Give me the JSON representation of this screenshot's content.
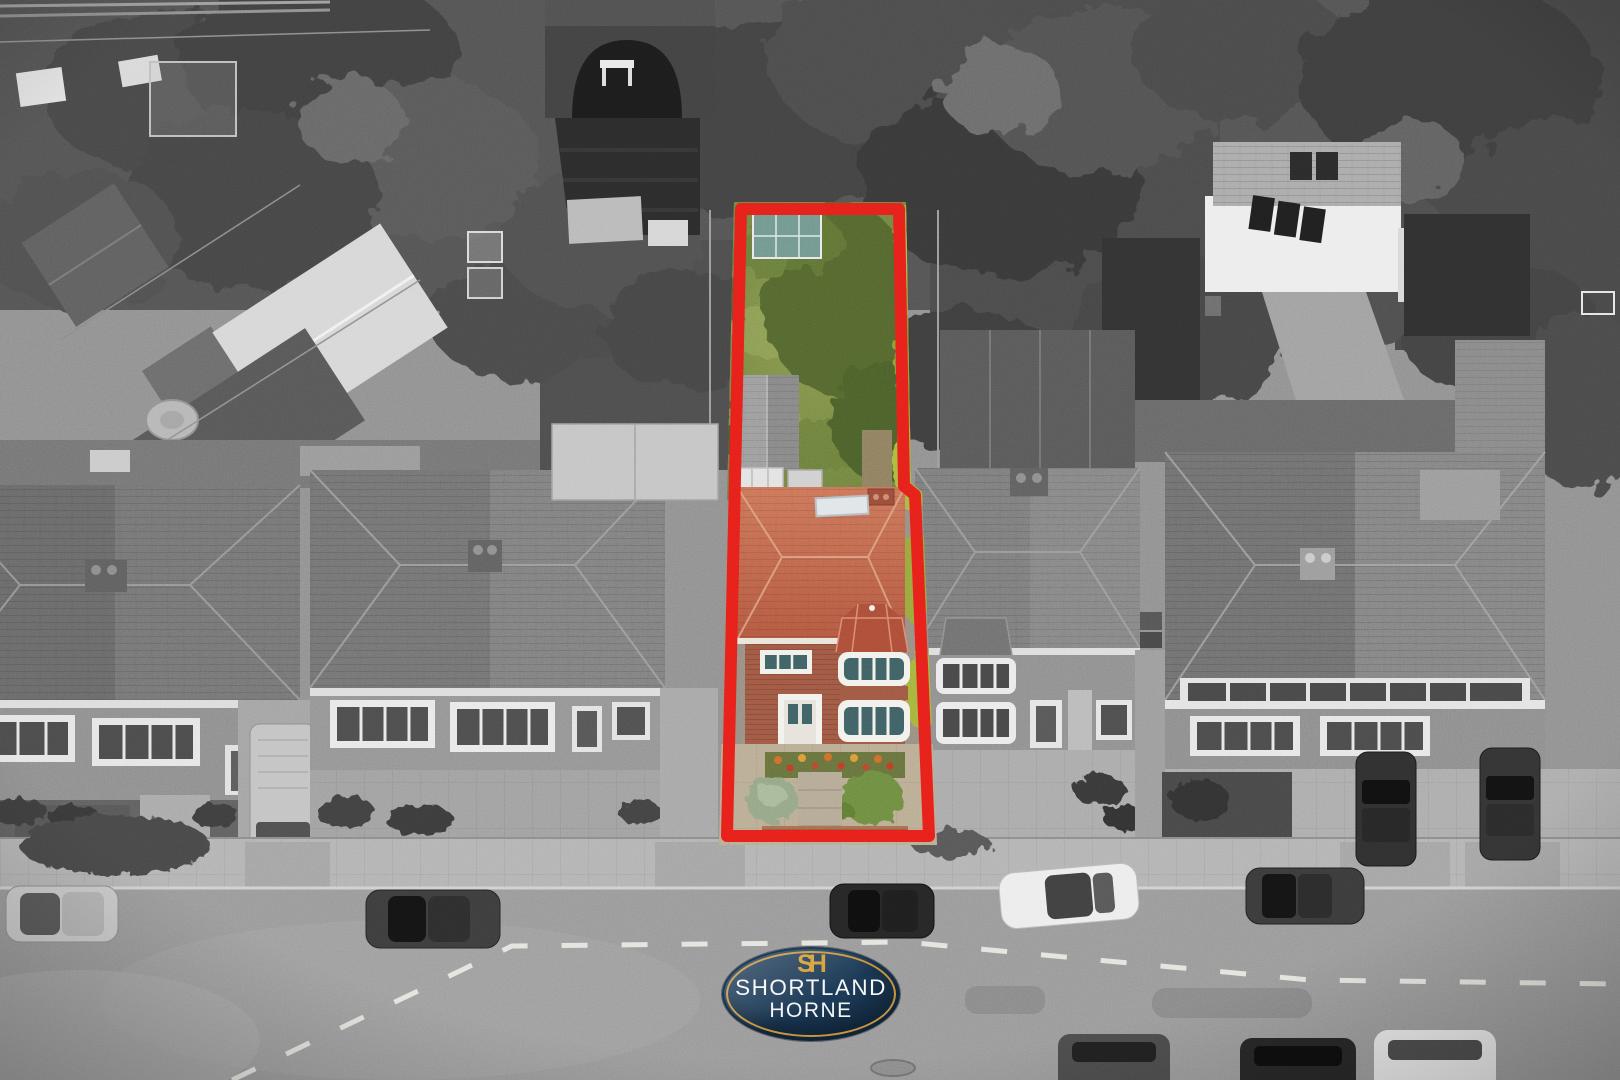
{
  "brand": {
    "monogram": "SH",
    "line1": "SHORTLAND",
    "line2": "HORNE"
  },
  "highlight": {
    "outline_width": 12,
    "polygon": [
      [
        741,
        209
      ],
      [
        899,
        209
      ],
      [
        904,
        486
      ],
      [
        915,
        495
      ],
      [
        929,
        836
      ],
      [
        727,
        836
      ]
    ],
    "clip": [
      [
        734,
        202
      ],
      [
        906,
        202
      ],
      [
        911,
        483
      ],
      [
        922,
        492
      ],
      [
        937,
        845
      ],
      [
        719,
        845
      ]
    ]
  },
  "palette": {
    "outline-red": "#e6201a",
    "badge-navy": "#1d3b58",
    "badge-navy-dark": "#0f2438",
    "badge-gold": "#c8953c",
    "monogram-gold": "#d69d2d",
    "brand-text": "#f4f6f8",
    "roof-terracotta": "#cb7458",
    "roof-terracotta-dark": "#b2573f",
    "bay-roof-red": "#ab4c38",
    "house-brick": "#9e5742",
    "garden-grass": "#85964d",
    "garden-grass-dark": "#697c3c",
    "garden-hedge": "#9cab3e",
    "tree-canopy-green": "#52652f",
    "front-wall-brick": "#a86b4f"
  }
}
